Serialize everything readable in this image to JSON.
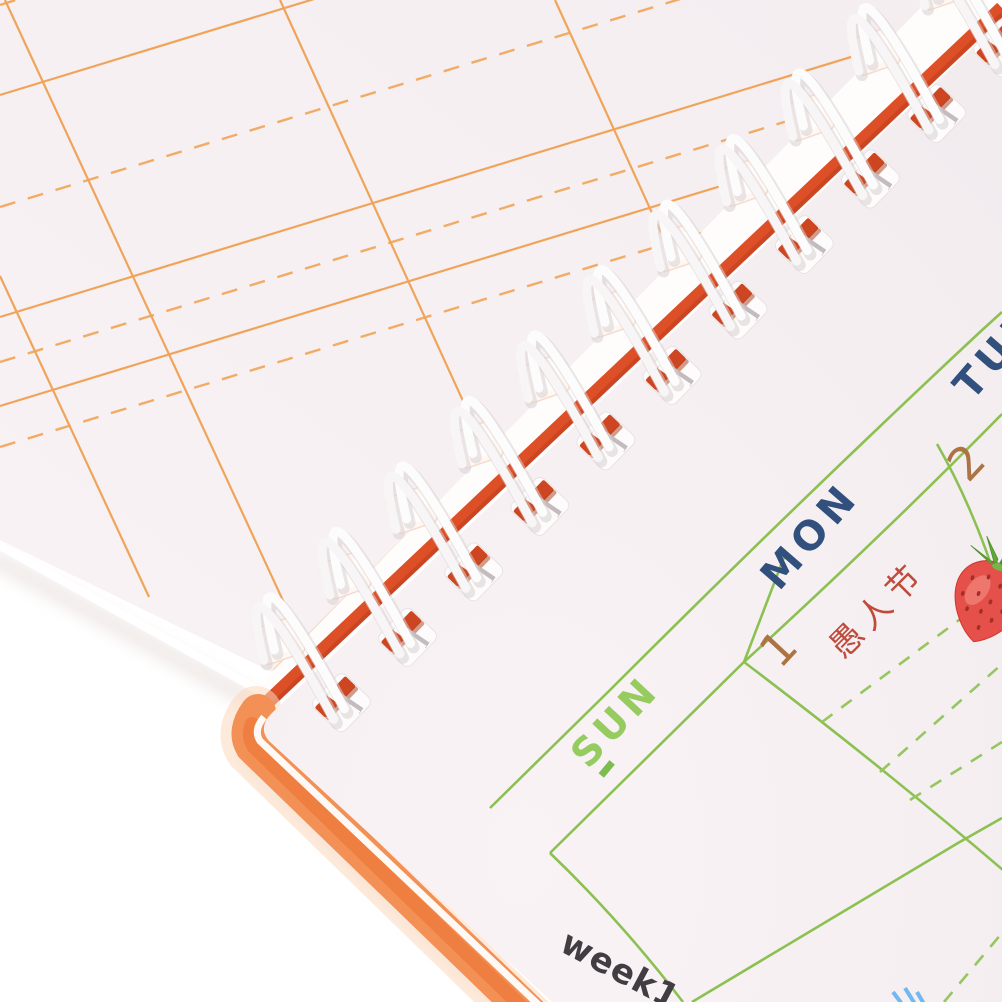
{
  "photo": {
    "description": "Close-up product photo of a white wire-o spiral bound weekly planner notebook, tilted diagonally on a white background",
    "binding": {
      "coil_color": "#fdfcfc",
      "spine_strip_color": "#dd4f26",
      "cover_color": "#f29055"
    },
    "back_page": {
      "ruling_color": "#f0a45a"
    }
  },
  "planner": {
    "week_label": "week1",
    "day_sun": "SUN",
    "day_mon": "MON",
    "day_tue": "TUE",
    "date_mon": "1",
    "date_tue": "2",
    "holiday_mon": "愚人节",
    "grid_color": "#8cc152",
    "grid_dash_color": "#95c75e",
    "day_sun_color": "#96cb60",
    "day_weekday_color": "#31507d",
    "date_color": "#ad7343",
    "holiday_color": "#bf4b3c",
    "week_label_color": "#413d42"
  }
}
